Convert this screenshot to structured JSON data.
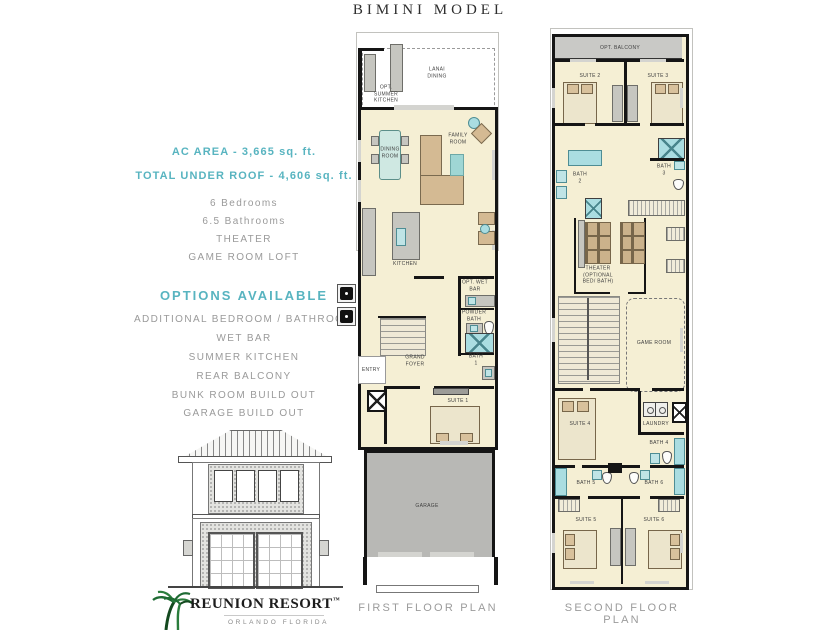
{
  "title": "BIMINI MODEL",
  "specs": {
    "ac_area": "AC AREA - 3,665 sq. ft.",
    "total_under_roof": "TOTAL UNDER ROOF - 4,606 sq. ft.",
    "features": [
      "6 Bedrooms",
      "6.5 Bathrooms",
      "THEATER",
      "GAME ROOM LOFT"
    ]
  },
  "options": {
    "heading": "OPTIONS AVAILABLE",
    "items": [
      "ADDITIONAL BEDROOM / BATHROOM",
      "WET BAR",
      "SUMMER KITCHEN",
      "REAR BALCONY",
      "BUNK ROOM BUILD OUT",
      "GARAGE BUILD OUT"
    ]
  },
  "logo": {
    "icon": "palm-trees-icon",
    "name": "REUNION RESORT",
    "trademark": "™",
    "subtitle": "ORLANDO FLORIDA"
  },
  "first_floor": {
    "caption": "FIRST FLOOR PLAN",
    "rooms": {
      "lanai": "LANAI\nDINING",
      "summer_kitchen": "OPT.\nSUMMER\nKITCHEN",
      "dining": "DINING\nROOM",
      "family": "FAMILY\nROOM",
      "kitchen": "KITCHEN",
      "wet_bar": "OPT. WET BAR",
      "powder": "POWDER\nBATH",
      "foyer": "GRAND\nFOYER",
      "entry": "ENTRY",
      "bath1": "BATH\n1",
      "suite1": "SUITE 1",
      "garage": "GARAGE"
    }
  },
  "second_floor": {
    "caption": "SECOND FLOOR PLAN",
    "rooms": {
      "balcony": "OPT. BALCONY",
      "suite2": "SUITE 2",
      "suite3": "SUITE 3",
      "bath2": "BATH\n2",
      "bath3": "BATH\n3",
      "theater": "THEATER\n(OPTIONAL\nBED/ BATH)",
      "game": "GAME ROOM",
      "suite4": "SUITE 4",
      "laundry": "LAUNDRY",
      "bath4": "BATH 4",
      "bath5": "BATH 5",
      "bath6": "BATH 6",
      "suite5": "SUITE 5",
      "suite6": "SUITE 6"
    }
  },
  "colors": {
    "accent_teal_text": "#58b4c0",
    "plan_teal": "#aadde1",
    "floor_cream": "#f5efd4",
    "wall_black": "#151515",
    "furniture_tan": "#d4ba93",
    "garage_gray": "#b8b8b5",
    "balcony_gray": "#c9c9c6",
    "muted_text_gray": "#9a9a9a",
    "logo_green": "#1e6b33"
  }
}
